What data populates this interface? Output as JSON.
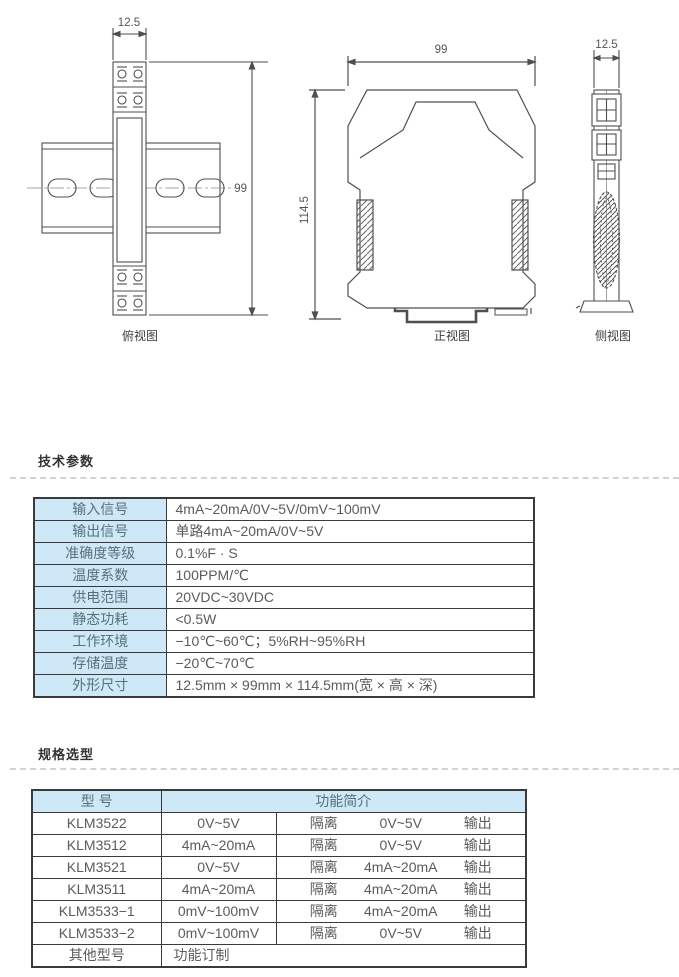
{
  "drawings": {
    "top_view": {
      "caption": "俯视图",
      "dim_width": "12.5",
      "dim_height": "99"
    },
    "front_view": {
      "caption": "正视图",
      "dim_width": "99",
      "dim_height": "114.5"
    },
    "side_view": {
      "caption": "侧视图",
      "dim_width": "12.5"
    }
  },
  "tech": {
    "heading": "技术参数",
    "rows": [
      {
        "label": "输入信号",
        "value": "4mA~20mA/0V~5V/0mV~100mV"
      },
      {
        "label": "输出信号",
        "value": "单路4mA~20mA/0V~5V"
      },
      {
        "label": "准确度等级",
        "value": "0.1%F · S"
      },
      {
        "label": "温度系数",
        "value": "100PPM/℃"
      },
      {
        "label": "供电范围",
        "value": "20VDC~30VDC"
      },
      {
        "label": "静态功耗",
        "value": "<0.5W"
      },
      {
        "label": "工作环境",
        "value": "−10℃~60℃；5%RH~95%RH"
      },
      {
        "label": "存储温度",
        "value": "−20℃~70℃"
      },
      {
        "label": "外形尺寸",
        "value": "12.5mm × 99mm × 114.5mm(宽 × 高 × 深)"
      }
    ]
  },
  "spec": {
    "heading": "规格选型",
    "header_model": "型 号",
    "header_desc": "功能简介",
    "rows": [
      {
        "model": "KLM3522",
        "input": "0V~5V",
        "iso": "隔离",
        "signal": "0V~5V",
        "out": "输出"
      },
      {
        "model": "KLM3512",
        "input": "4mA~20mA",
        "iso": "隔离",
        "signal": "0V~5V",
        "out": "输出"
      },
      {
        "model": "KLM3521",
        "input": "0V~5V",
        "iso": "隔离",
        "signal": "4mA~20mA",
        "out": "输出"
      },
      {
        "model": "KLM3511",
        "input": "4mA~20mA",
        "iso": "隔离",
        "signal": "4mA~20mA",
        "out": "输出"
      },
      {
        "model": "KLM3533−1",
        "input": "0mV~100mV",
        "iso": "隔离",
        "signal": "4mA~20mA",
        "out": "输出"
      },
      {
        "model": "KLM3533−2",
        "input": "0mV~100mV",
        "iso": "隔离",
        "signal": "0V~5V",
        "out": "输出"
      }
    ],
    "other_model": "其他型号",
    "other_desc": "功能订制"
  },
  "colors": {
    "header_blue": "#cfe8f7",
    "table_border": "#3a3a3a",
    "text_gray": "#595959"
  }
}
